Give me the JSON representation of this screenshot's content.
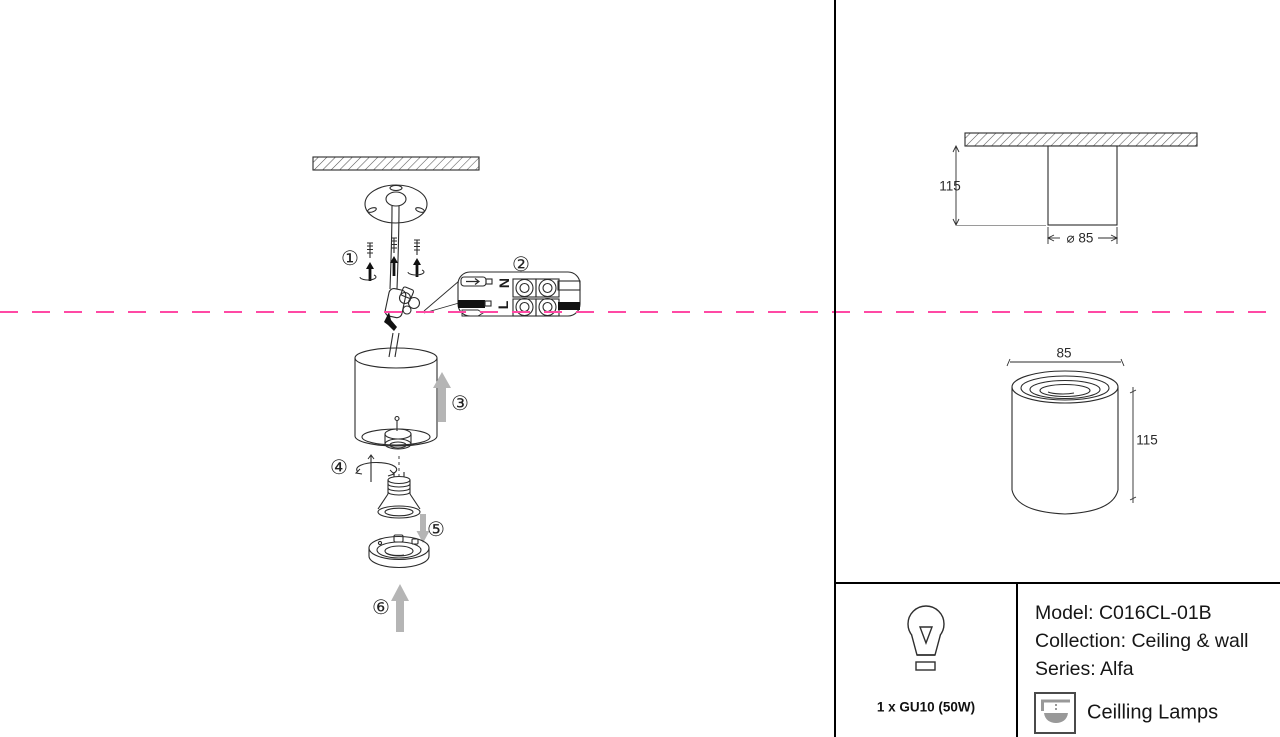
{
  "colors": {
    "accent_pink": "#ff49a4",
    "line": "#2b2b2b",
    "arrow_gray": "#b5b5b5"
  },
  "install": {
    "steps": [
      "①",
      "②",
      "③",
      "④",
      "⑤",
      "⑥"
    ],
    "connector": {
      "n": "N",
      "l": "L"
    }
  },
  "dimensions": {
    "front_view": {
      "height": "115",
      "diameter": "⌀ 85"
    },
    "iso_view": {
      "width": "85",
      "height": "115"
    }
  },
  "spec": {
    "bulb": "1 x GU10 (50W)",
    "model": "Model: C016CL-01B",
    "collection": "Collection: Ceiling & wall",
    "series": "Series: Alfa",
    "category": "Ceilling Lamps"
  }
}
